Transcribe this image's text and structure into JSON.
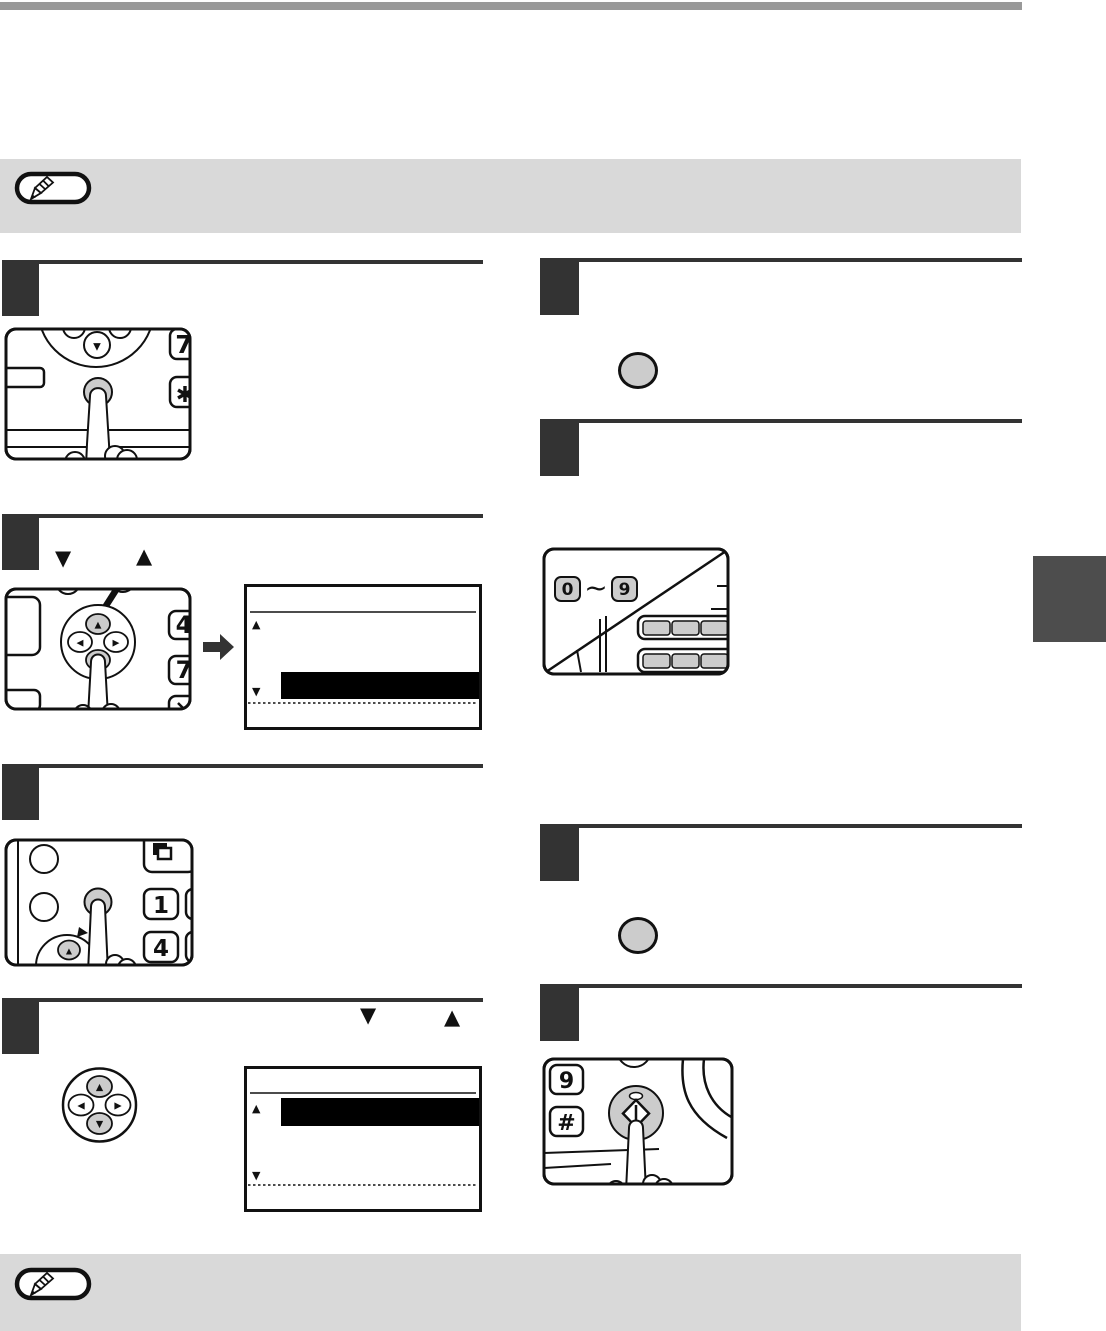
{
  "colors": {
    "top_bar": "#999999",
    "note_band": "#d9d9d9",
    "step_box": "#333333",
    "side_tab": "#4d4d4d",
    "key_gray": "#cccccc",
    "line": "#111111",
    "arrow_dark": "#333333"
  },
  "headings": {
    "step2_left": {
      "down_key_glyph": "▼",
      "up_key_glyph": "▲"
    },
    "step4_left": {
      "down_key_glyph": "▼",
      "up_key_glyph": "▲"
    }
  },
  "panels": {
    "menu_key_panel": {
      "key_7": "7",
      "key_asterisk": "✱",
      "wheel_down": "▼"
    },
    "arrow_pad_panel": {
      "key_4": "4",
      "key_7": "7",
      "pad_up": "▲",
      "pad_down": "▼",
      "pad_left": "◀",
      "pad_right": "▶"
    },
    "display_select_1": {
      "scroll_up": "▲",
      "scroll_down": "▼"
    },
    "ok_key_panel": {
      "key_1": "1",
      "key_4": "4",
      "pad_up": "▲"
    },
    "arrow_pad_icon": {
      "up": "▲",
      "down": "▼",
      "left": "◀",
      "right": "▶"
    },
    "display_select_2": {
      "scroll_up": "▲",
      "scroll_down": "▼"
    },
    "numeric_keys_panel": {
      "key_0": "0",
      "tilde": "~",
      "key_9": "9"
    },
    "start_key_panel": {
      "key_9": "9",
      "key_hash": "#"
    }
  }
}
